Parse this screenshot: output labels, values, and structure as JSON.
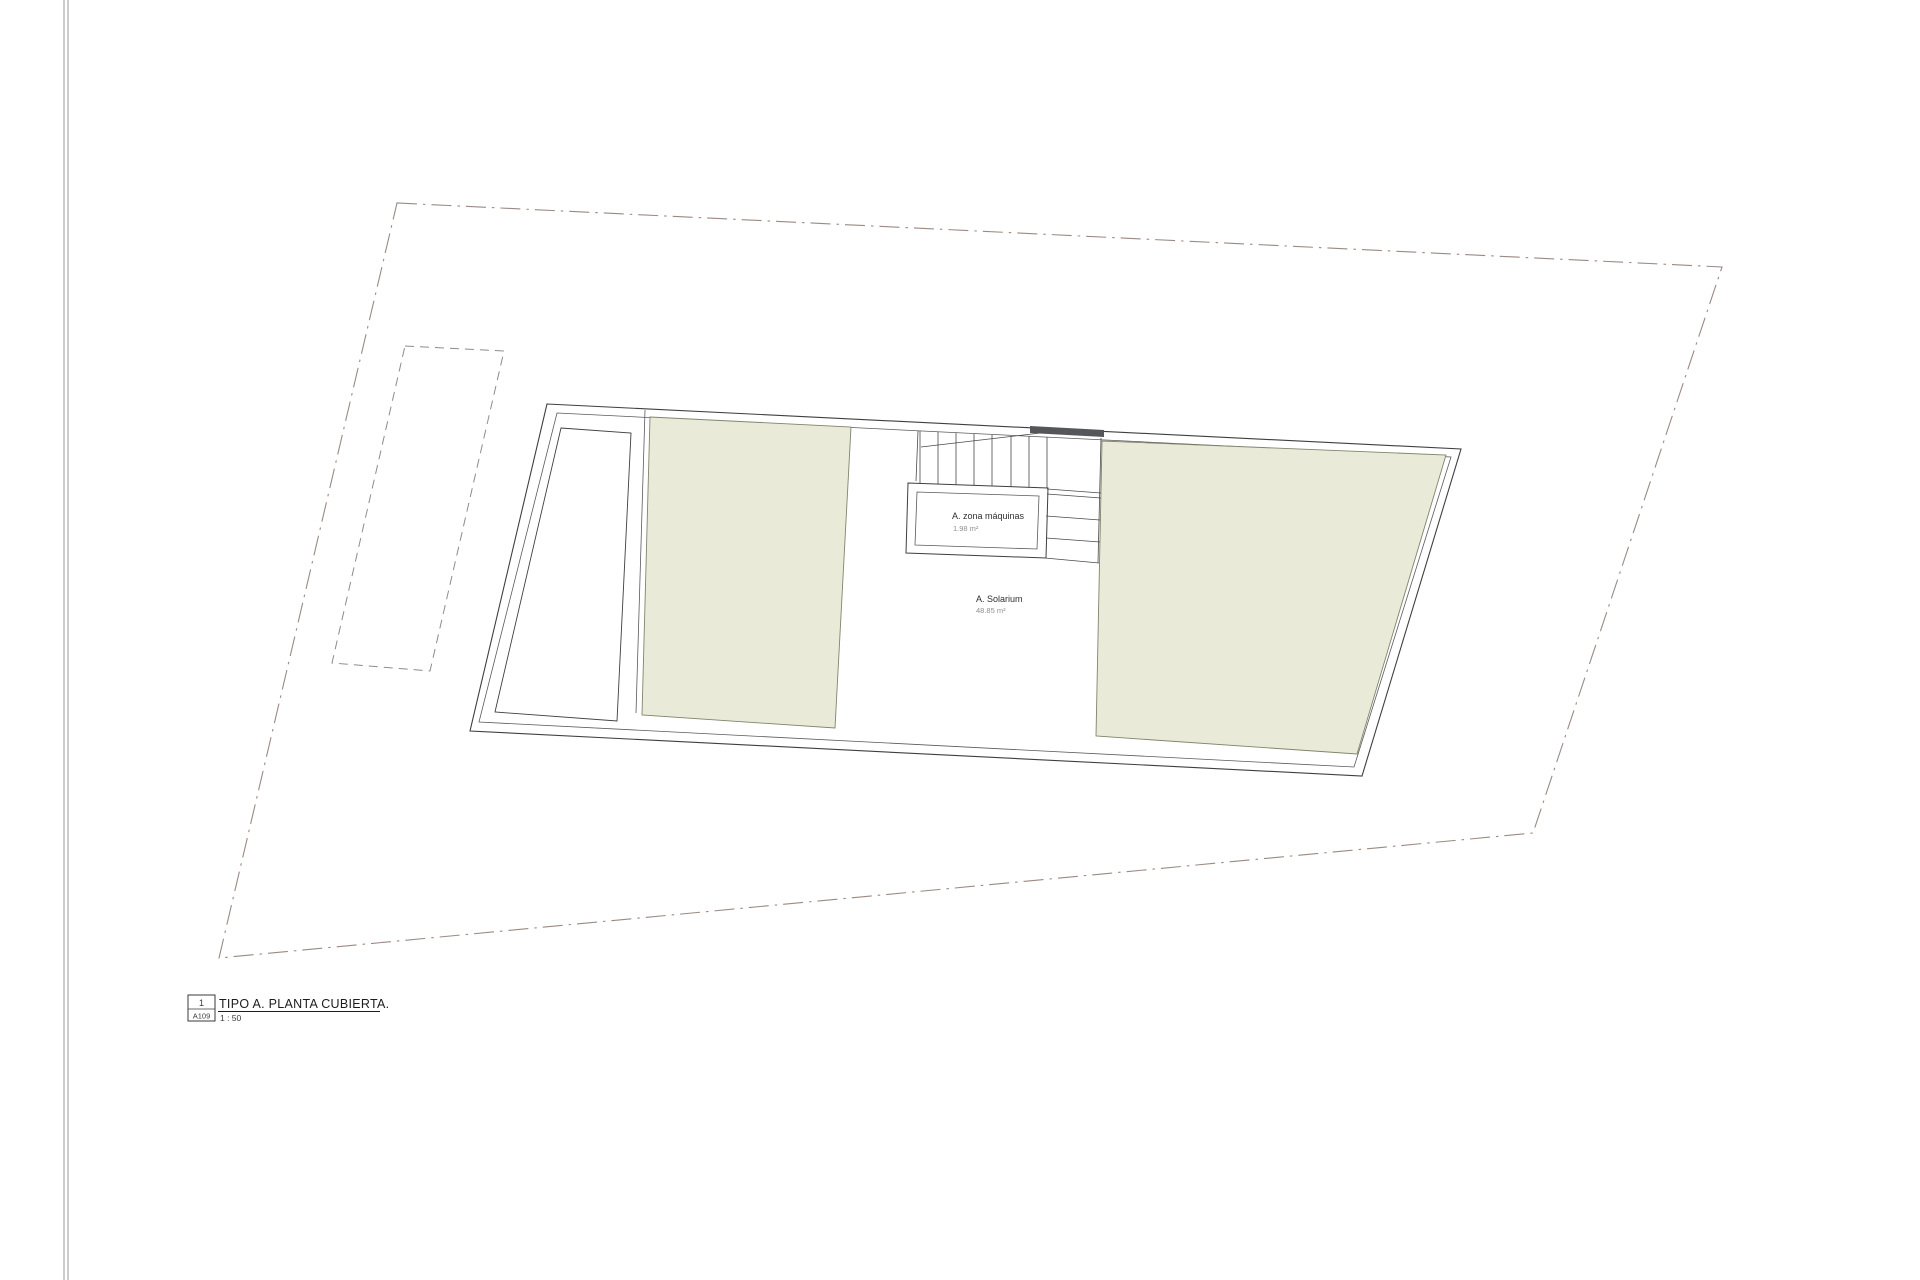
{
  "drawing": {
    "rooms": {
      "machine_room": {
        "label": "A. zona máquinas",
        "area": "1.98 m²"
      },
      "solarium": {
        "label": "A. Solarium",
        "area": "48.85 m²"
      }
    },
    "colors": {
      "roof_fill": "#e9ebd8",
      "roof_stroke": "#82846f",
      "line": "#3f3f3f",
      "inner_line": "#5a5a5a",
      "boundary": "#9a8a83",
      "dashed_rect": "#8c8c8c",
      "stair_bar": "#55565a",
      "page_edge": "#9a9a9a"
    }
  },
  "title_block": {
    "number": "1",
    "sheet": "A109",
    "title": "TIPO A. PLANTA CUBIERTA.",
    "scale": "1 : 50"
  }
}
